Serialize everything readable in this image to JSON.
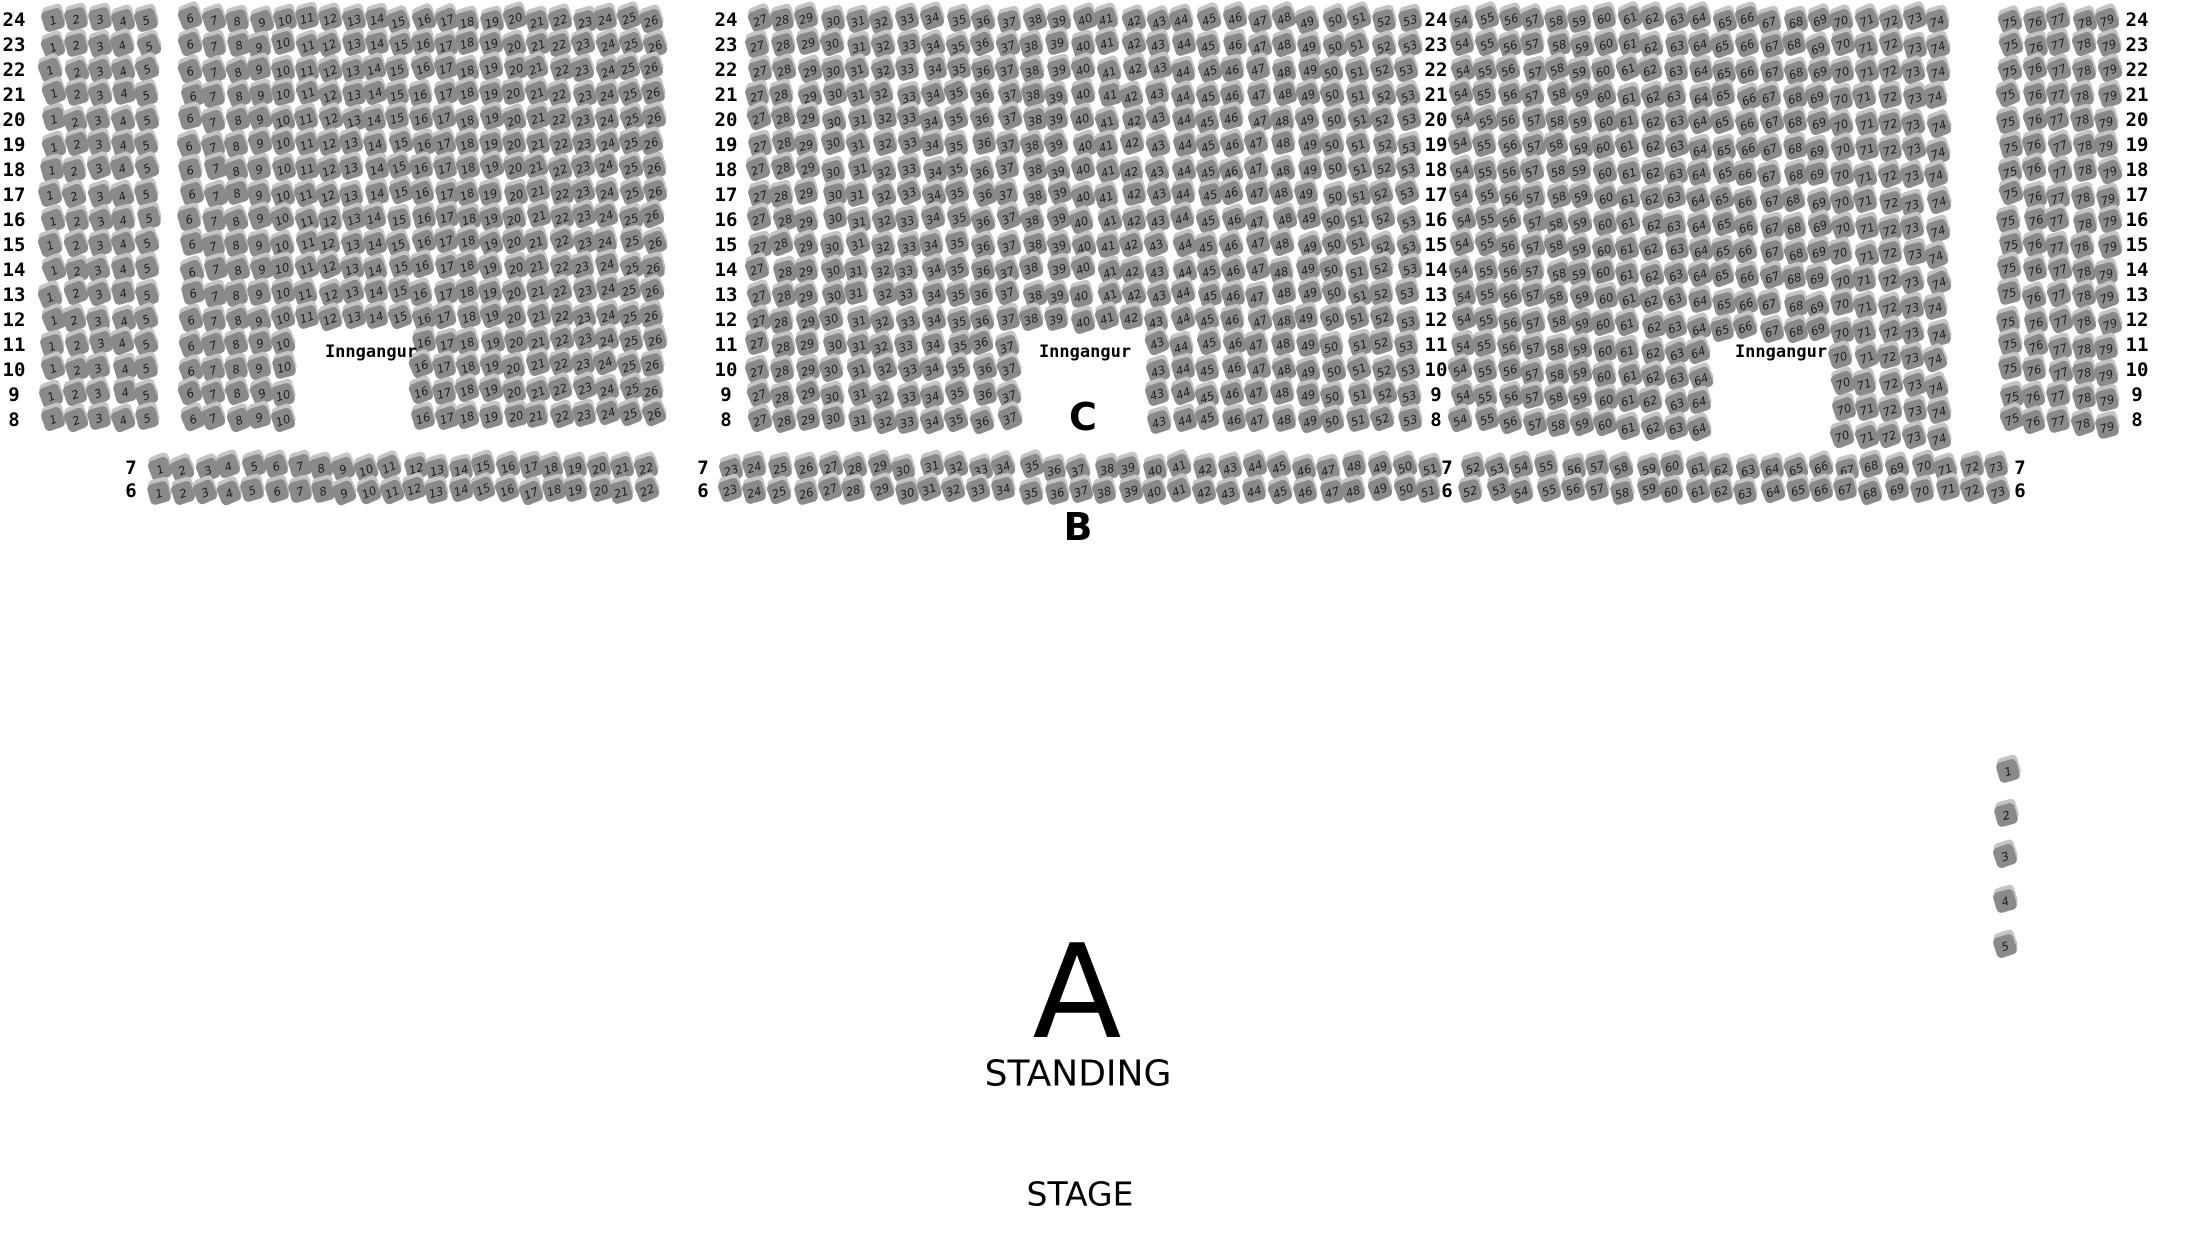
{
  "labels": {
    "section_c": "C",
    "section_b": "B",
    "section_a": "A",
    "standing": "STANDING",
    "stage": "STAGE",
    "entrance": "Inngangur"
  },
  "colors": {
    "background": "#ffffff",
    "seat_fill": "#8a8a8a",
    "seat_shadow": "#c4c4c4",
    "seat_number": "#1e1e1e",
    "text": "#000000"
  },
  "sections": {
    "c": {
      "row_labels": [
        24,
        23,
        22,
        21,
        20,
        19,
        18,
        17,
        16,
        15,
        14,
        13,
        12,
        11,
        10,
        9,
        8
      ],
      "blocks": [
        {
          "id": "c1",
          "seat_from": 1,
          "seat_to": 5
        },
        {
          "id": "c2",
          "seat_from": 6,
          "seat_to": 26,
          "entrance_gap": {
            "rows_from": 11,
            "rows_to": 8,
            "seat_from": 11,
            "seat_to": 15
          }
        },
        {
          "id": "c3",
          "seat_from": 27,
          "seat_to": 53,
          "entrance_gap": {
            "rows_from": 11,
            "rows_to": 8,
            "seat_from": 38,
            "seat_to": 42
          }
        },
        {
          "id": "c4",
          "seat_from": 54,
          "seat_to": 74,
          "entrance_gap": {
            "rows_from": 11,
            "rows_to": 8,
            "seat_from": 65,
            "seat_to": 69
          }
        },
        {
          "id": "c5",
          "seat_from": 75,
          "seat_to": 79
        }
      ]
    },
    "b": {
      "row_labels": [
        7,
        6
      ],
      "blocks": [
        {
          "id": "b1",
          "seat_from": 1,
          "seat_to": 22
        },
        {
          "id": "b2",
          "seat_from": 23,
          "seat_to": 51
        },
        {
          "id": "b3",
          "seat_from": 52,
          "seat_to": 73
        }
      ]
    },
    "side": {
      "seat_numbers": [
        1,
        2,
        3,
        4,
        5
      ]
    }
  }
}
